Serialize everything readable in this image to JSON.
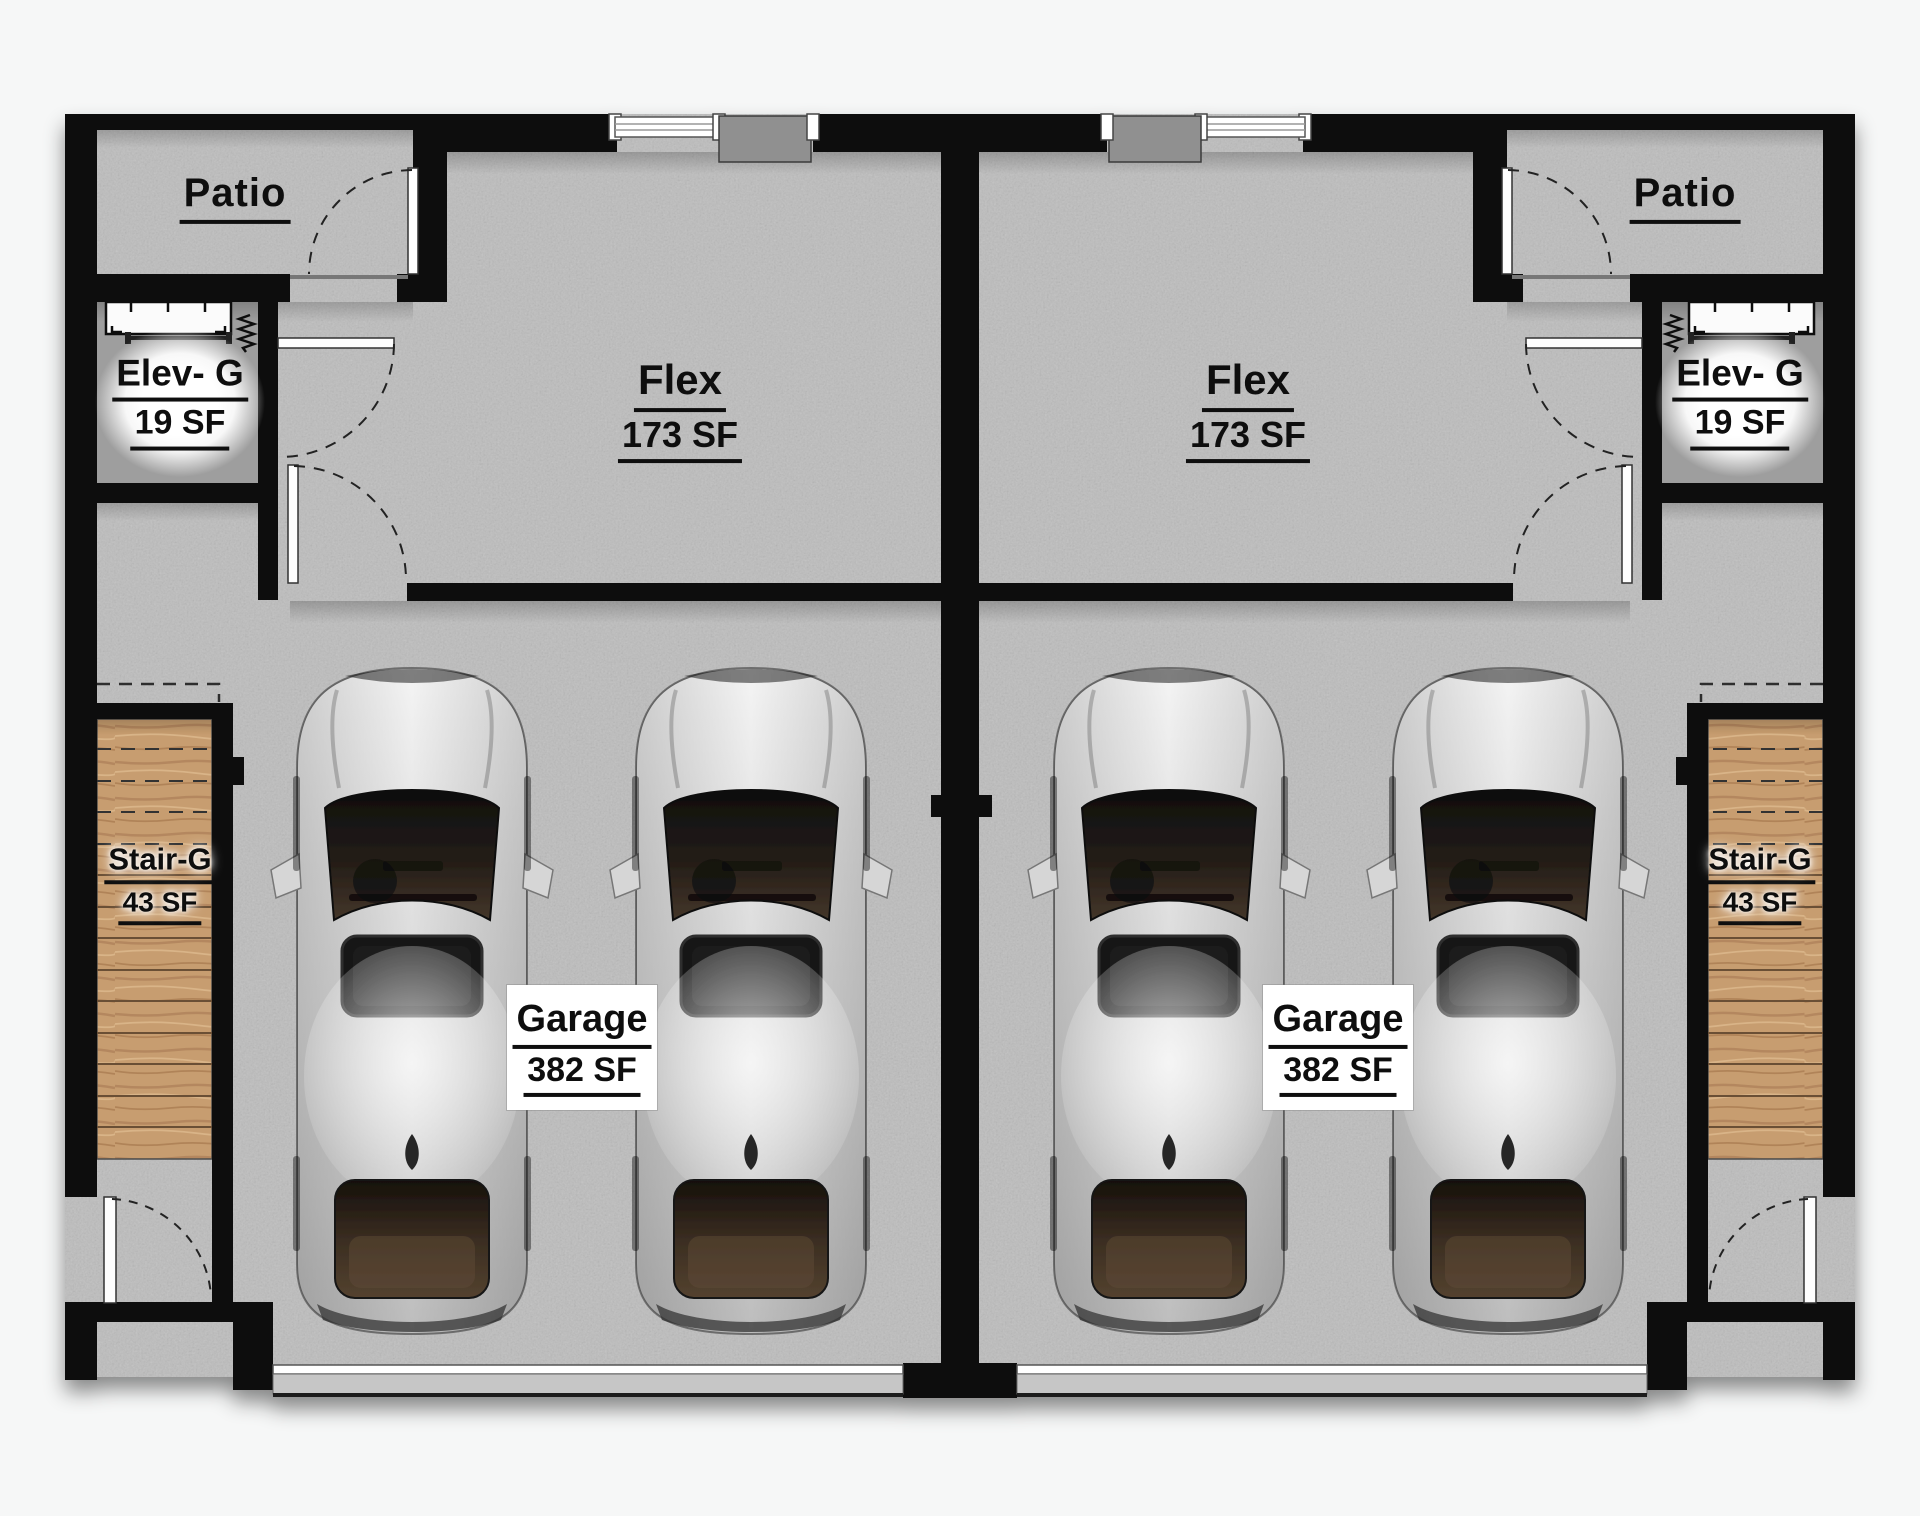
{
  "title": "Duplex garage level floor plan",
  "units": [
    {
      "id": "left",
      "patio_label": "Patio",
      "flex_name": "Flex",
      "flex_area": "173 SF",
      "elev_name": "Elev- G",
      "elev_area": "19 SF",
      "stair_name": "Stair-G",
      "stair_area": "43 SF",
      "garage_name": "Garage",
      "garage_area": "382 SF"
    },
    {
      "id": "right",
      "patio_label": "Patio",
      "flex_name": "Flex",
      "flex_area": "173 SF",
      "elev_name": "Elev- G",
      "elev_area": "19 SF",
      "stair_name": "Stair-G",
      "stair_area": "43 SF",
      "garage_name": "Garage",
      "garage_area": "382 SF"
    }
  ],
  "colors": {
    "wall": "#0b0b0b",
    "floor": "#bdbdbd",
    "elevator_shaft": "#9e9e9e",
    "wood": "#c79d6f",
    "door_leaf": "#fdfdfd",
    "car_glass": "#1c1c1c",
    "page": "#f6f7f7"
  }
}
